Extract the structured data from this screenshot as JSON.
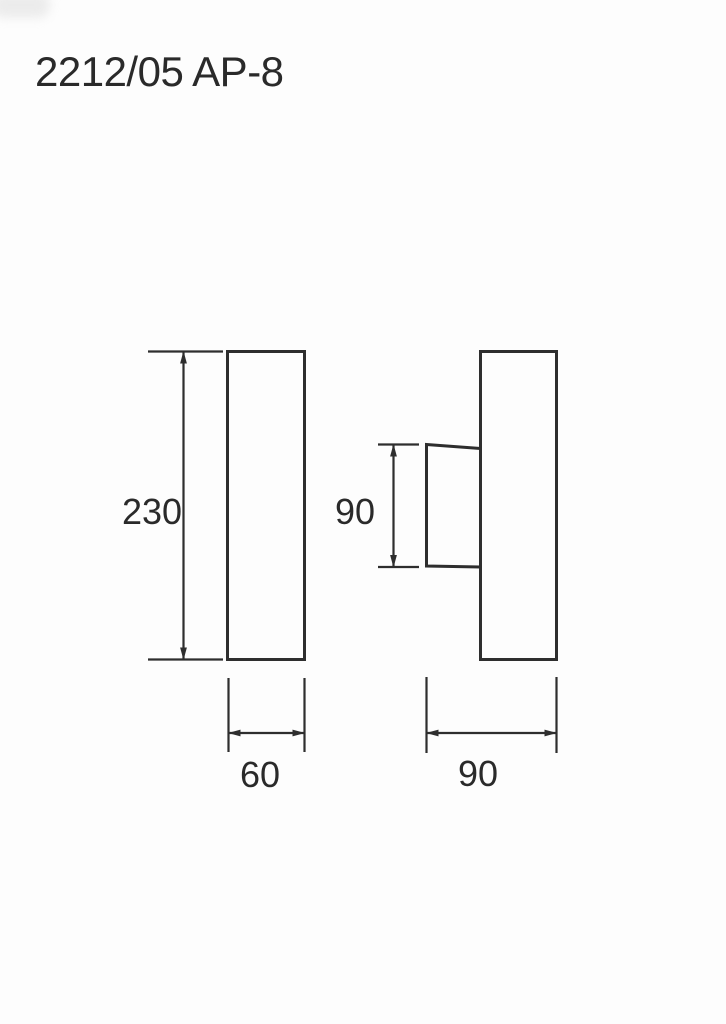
{
  "page": {
    "title": "2212/05 AP-8"
  },
  "colors": {
    "background": "#fdfdfd",
    "line": "#2e2e2e",
    "text": "#2a2a2a"
  },
  "front_view": {
    "height_dim_label": "230",
    "width_dim_label": "60"
  },
  "side_view": {
    "bracket_height_dim_label": "90",
    "depth_dim_label": "90"
  }
}
